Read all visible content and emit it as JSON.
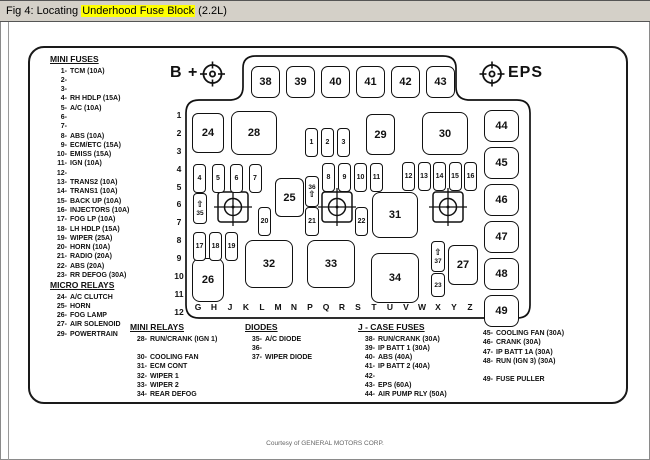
{
  "title": {
    "prefix": "Fig 4: Locating ",
    "highlight": "Underhood Fuse Block",
    "suffix": " (2.2L)"
  },
  "footer": {
    "credit": "Courtesy of GENERAL MOTORS CORP."
  },
  "diagram": {
    "b_plus_label": "B +",
    "eps_label": "EPS",
    "arrow_glyph": "⇧",
    "top_row": [
      "38",
      "39",
      "40",
      "41",
      "42",
      "43"
    ],
    "right_column": [
      "44",
      "45",
      "46",
      "47",
      "48",
      "49"
    ],
    "row_numbers": [
      "1",
      "2",
      "3",
      "4",
      "5",
      "6",
      "7",
      "8",
      "9",
      "10",
      "11",
      "12"
    ],
    "letters": [
      "G",
      "H",
      "J",
      "K",
      "L",
      "M",
      "N",
      "P",
      "Q",
      "R",
      "S",
      "T",
      "U",
      "V",
      "W",
      "X",
      "Y",
      "Z"
    ],
    "relay_boxes": {
      "r24": "24",
      "r28": "28",
      "r29": "29",
      "r30": "30",
      "r25": "25",
      "r31": "31",
      "r26": "26",
      "r32": "32",
      "r33": "33",
      "r34": "34",
      "r27": "27"
    },
    "minifuse_group1": [
      "1",
      "2",
      "3"
    ],
    "minifuse_group2": [
      "4",
      "5",
      "6",
      "7"
    ],
    "minifuse_group3": [
      "8",
      "9",
      "10",
      "11"
    ],
    "minifuse_group4": [
      "12",
      "13",
      "14",
      "15",
      "16"
    ],
    "minifuse_group5": [
      "17",
      "18",
      "19"
    ],
    "single_fuses": {
      "f20": "20",
      "f21": "21",
      "f22": "22",
      "f23": "23"
    },
    "diodes": {
      "d35": "35",
      "d36": "36",
      "d37": "37"
    }
  },
  "lists": {
    "mini_fuses": {
      "header": "MINI FUSES",
      "items": [
        {
          "n": "1-",
          "t": "TCM (10A)"
        },
        {
          "n": "2-",
          "t": ""
        },
        {
          "n": "3-",
          "t": ""
        },
        {
          "n": "4-",
          "t": "RH HDLP (15A)"
        },
        {
          "n": "5-",
          "t": "A/C (10A)"
        },
        {
          "n": "6-",
          "t": ""
        },
        {
          "n": "7-",
          "t": ""
        },
        {
          "n": "8-",
          "t": "ABS (10A)"
        },
        {
          "n": "9-",
          "t": "ECM/ETC (15A)"
        },
        {
          "n": "10-",
          "t": "EMISS (15A)"
        },
        {
          "n": "11-",
          "t": "IGN (10A)"
        },
        {
          "n": "12-",
          "t": ""
        },
        {
          "n": "13-",
          "t": "TRANS2 (10A)"
        },
        {
          "n": "14-",
          "t": "TRANS1 (10A)"
        },
        {
          "n": "15-",
          "t": "BACK UP (10A)"
        },
        {
          "n": "16-",
          "t": "INJECTORS (10A)"
        },
        {
          "n": "17-",
          "t": "FOG LP (10A)"
        },
        {
          "n": "18-",
          "t": "LH HDLP (15A)"
        },
        {
          "n": "19-",
          "t": "WIPER (25A)"
        },
        {
          "n": "20-",
          "t": "HORN (10A)"
        },
        {
          "n": "21-",
          "t": "RADIO (20A)"
        },
        {
          "n": "22-",
          "t": "ABS (20A)"
        },
        {
          "n": "23-",
          "t": "RR DEFOG (30A)"
        }
      ]
    },
    "micro_relays": {
      "header": "MICRO RELAYS",
      "items": [
        {
          "n": "24-",
          "t": "A/C CLUTCH"
        },
        {
          "n": "25-",
          "t": "HORN"
        },
        {
          "n": "26-",
          "t": "FOG LAMP"
        },
        {
          "n": "27-",
          "t": "AIR SOLENOID"
        },
        {
          "n": "29-",
          "t": "POWERTRAIN"
        }
      ]
    },
    "mini_relays": {
      "header": "MINI RELAYS",
      "items": [
        {
          "n": "28-",
          "t": "RUN/CRANK (IGN 1)"
        },
        {
          "n": "",
          "t": ""
        },
        {
          "n": "30-",
          "t": "COOLING FAN"
        },
        {
          "n": "31-",
          "t": "ECM CONT"
        },
        {
          "n": "32-",
          "t": "WIPER 1"
        },
        {
          "n": "33-",
          "t": "WIPER 2"
        },
        {
          "n": "34-",
          "t": "REAR DEFOG"
        }
      ]
    },
    "diodes": {
      "header": "DIODES",
      "items": [
        {
          "n": "35-",
          "t": "A/C DIODE"
        },
        {
          "n": "36-",
          "t": ""
        },
        {
          "n": "37-",
          "t": "WIPER DIODE"
        }
      ]
    },
    "jcase": {
      "header": "J - CASE FUSES",
      "items": [
        {
          "n": "38-",
          "t": "RUN/CRANK (30A)"
        },
        {
          "n": "39-",
          "t": "IP BATT 1 (30A)"
        },
        {
          "n": "40-",
          "t": "ABS (40A)"
        },
        {
          "n": "41-",
          "t": "IP BATT 2 (40A)"
        },
        {
          "n": "42-",
          "t": ""
        },
        {
          "n": "43-",
          "t": "EPS (60A)"
        },
        {
          "n": "44-",
          "t": "AIR PUMP RLY (50A)"
        }
      ]
    },
    "right_list": {
      "items": [
        {
          "n": "45-",
          "t": "COOLING FAN (30A)"
        },
        {
          "n": "46-",
          "t": "CRANK (30A)"
        },
        {
          "n": "47-",
          "t": "IP BATT 1A (30A)"
        },
        {
          "n": "48-",
          "t": "RUN (IGN 3) (30A)"
        },
        {
          "n": "",
          "t": ""
        },
        {
          "n": "49-",
          "t": "FUSE PULLER"
        }
      ]
    }
  }
}
